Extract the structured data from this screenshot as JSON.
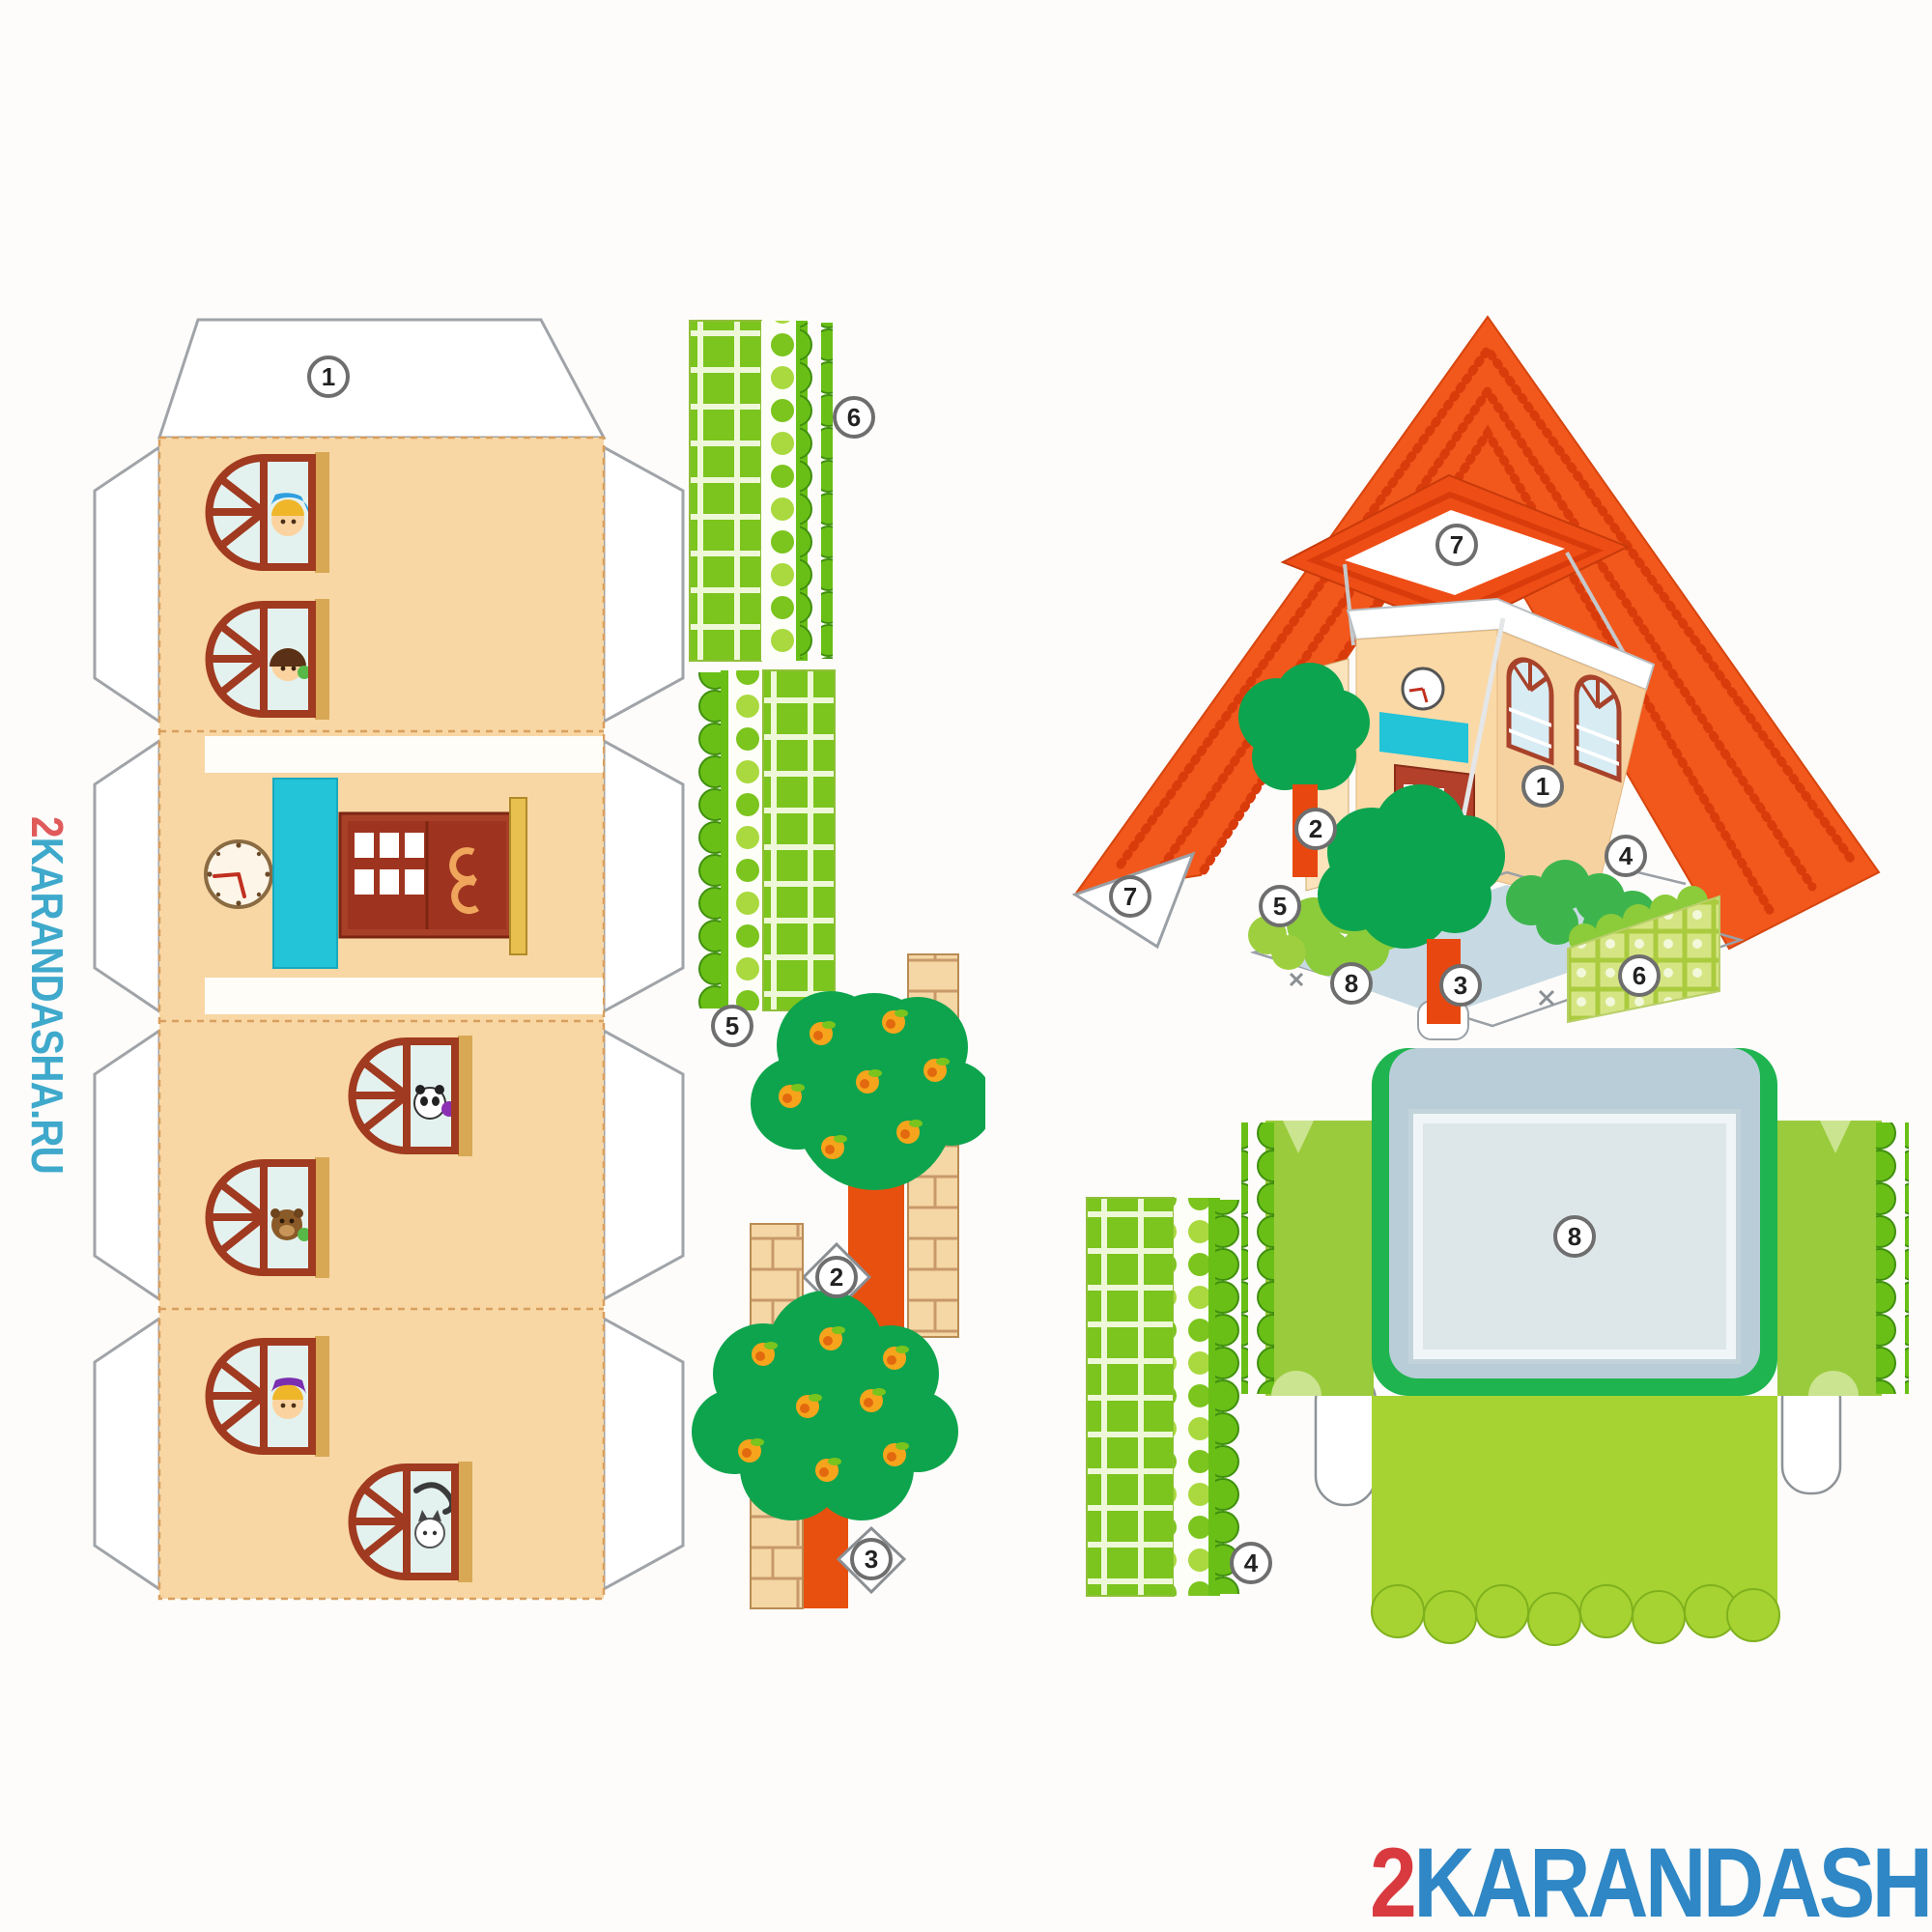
{
  "document": {
    "kind": "papercraft cut-out sheet of a toy house"
  },
  "watermark": {
    "prefix": "2",
    "domain": "KARANDASHA.RU"
  },
  "callouts": {
    "template_roof_flap": "1",
    "strip_right": "6",
    "strip_left": "5",
    "tree_tall_tab": "2",
    "tree_round_tab": "3",
    "strip_mat": "4",
    "mat_center": "8",
    "asm_roof_corner": "7",
    "asm_roof_top": "7",
    "asm_wall": "1",
    "asm_tree_tall": "2",
    "asm_hedge_left": "5",
    "asm_hedge_right": "4",
    "asm_base": "8",
    "asm_tree_round": "3",
    "asm_fence": "6"
  },
  "colors": {
    "wall_peach": "#f8d7a4",
    "roof_orange": "#f2571c",
    "roof_stripe": "#d93b0b",
    "hedge_green": "#7cc41e",
    "canopy_green": "#0ea44d",
    "trunk_orange": "#e8500f",
    "sign_cyan": "#23c3d8",
    "door_red": "#a84028",
    "mat_blue": "#b9cdd9",
    "grass_green": "#9acb3c",
    "watermark_red": "#d93a40",
    "watermark_blue": "#2f87c5"
  }
}
